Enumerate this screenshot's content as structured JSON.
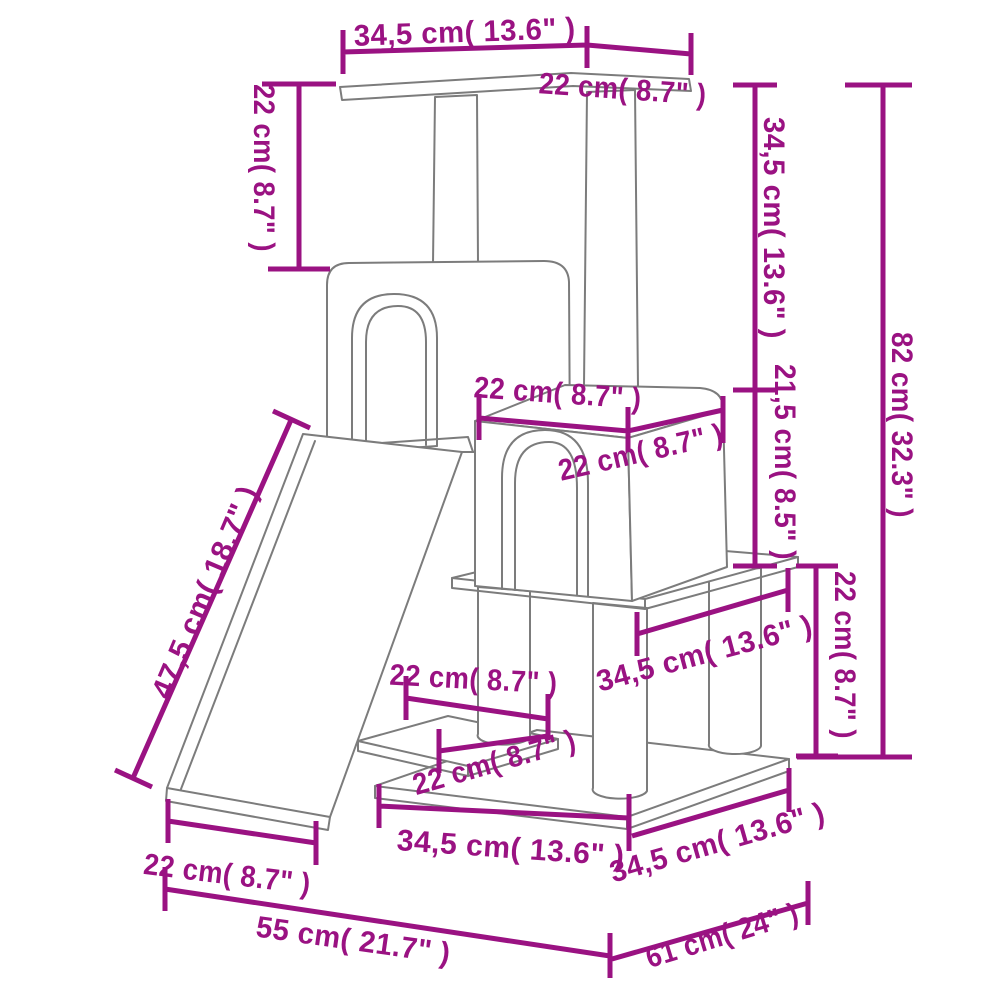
{
  "diagram": {
    "kind": "product-dimension-diagram",
    "subject": "cat tree with scratching posts, two houses, ramp, step and platforms",
    "colors": {
      "dimension_accent": "#9a1282",
      "drawing_outline": "#7c7c7c",
      "background": "#ffffff"
    },
    "units": "cm (inches)",
    "dimensions": {
      "top_board_length": {
        "label": "34,5 cm( 13.6\" )"
      },
      "top_board_depth": {
        "label": "22 cm( 8.7\" )"
      },
      "top_post_height": {
        "label": "22 cm( 8.7\" )"
      },
      "upper_section_height": {
        "label": "34,5 cm( 13.6\" )"
      },
      "house_section_height": {
        "label": "21,5 cm( 8.5\" )"
      },
      "total_height": {
        "label": "82 cm( 32.3\" )"
      },
      "house_top_width": {
        "label": "22 cm( 8.7\" )"
      },
      "house_top_depth": {
        "label": "22 cm( 8.7\" )"
      },
      "lower_section_height": {
        "label": "22 cm( 8.7\" )"
      },
      "mid_platform_depth": {
        "label": "34,5 cm( 13.6\" )"
      },
      "ramp_length": {
        "label": "47,5 cm( 18.7\" )"
      },
      "step_width": {
        "label": "22 cm( 8.7\" )"
      },
      "step_depth": {
        "label": "22 cm( 8.7\" )"
      },
      "base_front_width": {
        "label": "34,5 cm( 13.6\" )"
      },
      "base_side_depth": {
        "label": "34,5 cm( 13.6\" )"
      },
      "ramp_width": {
        "label": "22 cm( 8.7\" )"
      },
      "footprint_width": {
        "label": "55 cm( 21.7\" )"
      },
      "footprint_depth": {
        "label": "61 cm( 24\" )"
      }
    }
  }
}
